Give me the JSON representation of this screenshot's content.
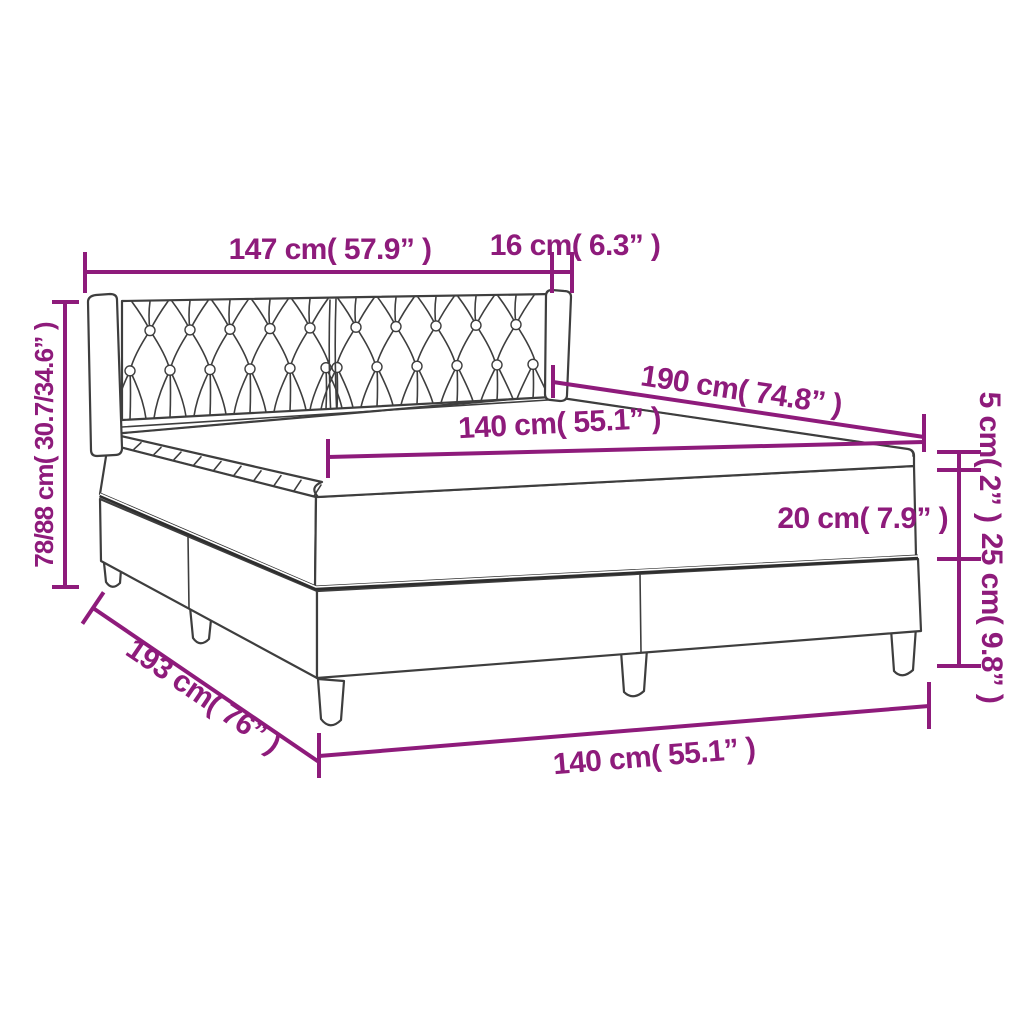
{
  "diagram": {
    "type": "product-dimension-diagram",
    "subject": "box-spring-bed-with-tufted-headboard",
    "colors": {
      "dimension": "#8E1B7B",
      "line_art": "#3E3E3E",
      "background": "#FFFFFF"
    },
    "labels": {
      "headboard_width": "147 cm( 57.9” )",
      "corner_depth": "16 cm( 6.3” )",
      "height_total": "78/88 cm( 30.7/34.6” )",
      "length_mattress": "190 cm( 74.8” )",
      "width_mattress_top": "140 cm( 55.1” )",
      "topper_height": "5 cm( 2” )",
      "mattress_height": "20 cm( 7.9” )",
      "base_height": "25 cm( 9.8” )",
      "length_total": "193 cm( 76” )",
      "width_base_bottom": "140 cm( 55.1” )"
    }
  }
}
